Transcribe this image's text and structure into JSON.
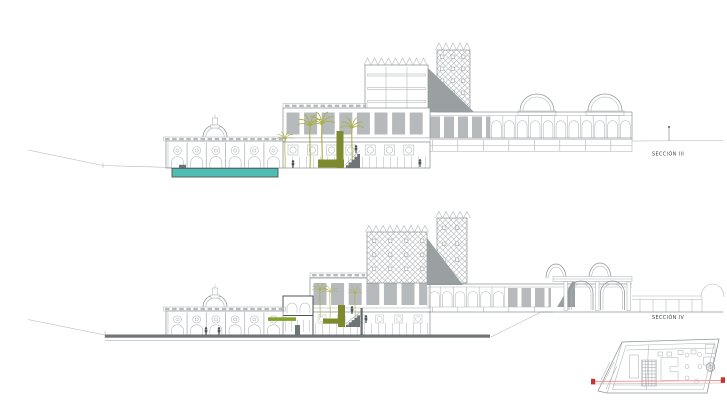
{
  "sheet": {
    "background": "#ffffff"
  },
  "sections": [
    {
      "id": "seccion-iii",
      "label": "SECCIÓN III"
    },
    {
      "id": "seccion-iv",
      "label": "SECCIÓN IV"
    }
  ],
  "colors": {
    "pool": "#4fbdb4",
    "palm": "#a8ae3c",
    "hedge": "#7d8a2e",
    "greenRoof": "#86a32e",
    "lineLight": "#afb3b5",
    "lineMid": "#8f9496",
    "lineDark": "#4f5456",
    "panel": "#b6babc",
    "wedge": "#9aa0a2",
    "slab": "#6f7476",
    "red": "#c63431",
    "redLine": "#e49c9a",
    "text": "#3f4446"
  }
}
